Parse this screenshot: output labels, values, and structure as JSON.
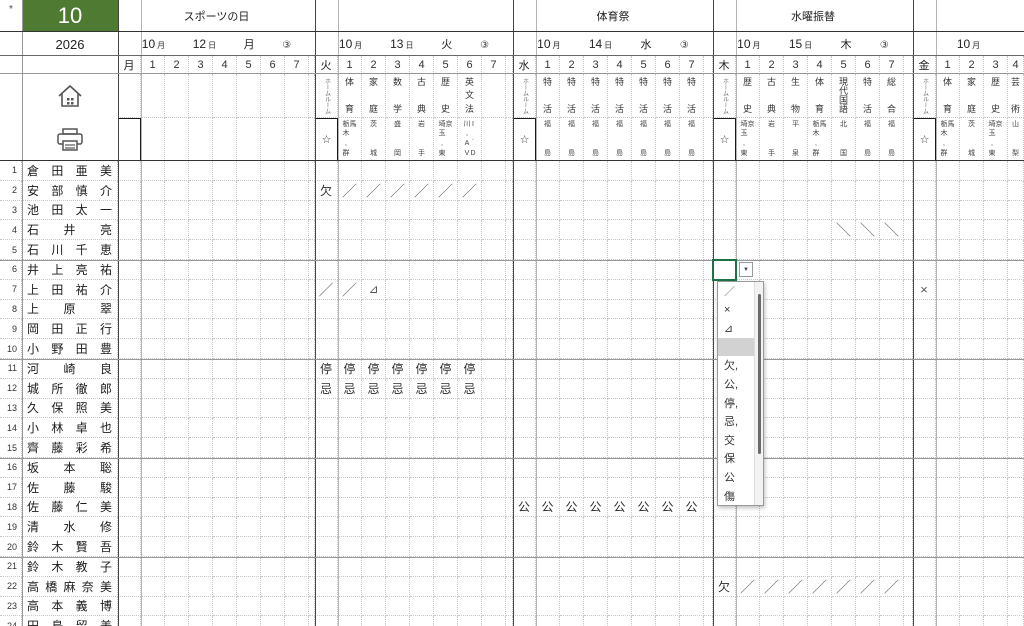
{
  "corner": "*",
  "title": {
    "month": "10",
    "year": "2026"
  },
  "banners": [
    "スポーツの日",
    "",
    "体育祭",
    "水曜振替",
    ""
  ],
  "periods": [
    "1",
    "2",
    "3",
    "4",
    "5",
    "6",
    "7"
  ],
  "blocks": [
    {
      "day": "月",
      "date_parts": [
        {
          "n": "10",
          "u": "月"
        },
        {
          "n": "12",
          "u": "日"
        },
        {
          "n": "月"
        },
        {
          "n": "③"
        }
      ],
      "homeroom": "",
      "star": "",
      "subjects": [
        "",
        "",
        "",
        "",
        "",
        "",
        ""
      ],
      "teachers": [
        "",
        "",
        "",
        "",
        "",
        "",
        ""
      ]
    },
    {
      "day": "火",
      "date_parts": [
        {
          "n": "10",
          "u": "月"
        },
        {
          "n": "13",
          "u": "日"
        },
        {
          "n": "火"
        },
        {
          "n": "③"
        }
      ],
      "homeroom": "ホームルーム",
      "star": "☆",
      "subjects": [
        "体育",
        "家庭",
        "数学",
        "古典",
        "歴史",
        "英文法",
        ""
      ],
      "teachers": [
        "栃木,群馬",
        "茨城",
        "盛岡",
        "岩手",
        "埼玉,東京",
        "川,AVI.D",
        ""
      ]
    },
    {
      "day": "水",
      "date_parts": [
        {
          "n": "10",
          "u": "月"
        },
        {
          "n": "14",
          "u": "日"
        },
        {
          "n": "水"
        },
        {
          "n": "③"
        }
      ],
      "homeroom": "ホームルーム",
      "star": "☆",
      "subjects": [
        "特活",
        "特活",
        "特活",
        "特活",
        "特活",
        "特活",
        "特活"
      ],
      "teachers": [
        "福島",
        "福島",
        "福島",
        "福島",
        "福島",
        "福島",
        "福島"
      ]
    },
    {
      "day": "木",
      "date_parts": [
        {
          "n": "10",
          "u": "月"
        },
        {
          "n": "15",
          "u": "日"
        },
        {
          "n": "木"
        },
        {
          "n": "③"
        }
      ],
      "homeroom": "ホームルーム",
      "star": "☆",
      "subjects": [
        "歴史",
        "古典",
        "生物",
        "体育",
        "現代国語",
        "特活",
        "総合"
      ],
      "teachers": [
        "埼玉,東京",
        "岩手",
        "平泉",
        "栃木,群馬",
        "北国",
        "福島",
        "福島"
      ]
    },
    {
      "day": "金",
      "date_parts": [
        {
          "n": "10",
          "u": "月"
        }
      ],
      "homeroom": "ホームルーム",
      "star": "☆",
      "subjects": [
        "体育",
        "家庭",
        "歴史",
        "芸術",
        "",
        "",
        ""
      ],
      "teachers": [
        "栃木,群馬",
        "茨城",
        "埼玉,東京",
        "山梨",
        "",
        "",
        ""
      ]
    }
  ],
  "students": [
    "倉田亜美",
    "安部慎介",
    "池田太一",
    "石井亮",
    "石川千恵",
    "井上亮祐",
    "上田祐介",
    "上原翠",
    "岡田正行",
    "小野田豊",
    "河崎良",
    "城所徹郎",
    "久保照美",
    "小林卓也",
    "齊藤彩希",
    "坂本聡",
    "佐藤駿",
    "佐藤仁美",
    "清水修",
    "鈴木賢吾",
    "鈴木教子",
    "高橋麻奈美",
    "高本義博",
    "田島留美"
  ],
  "marks": [
    {
      "row": 2,
      "block": 1,
      "cols": [
        0
      ],
      "text": "欠"
    },
    {
      "row": 2,
      "block": 1,
      "cols": [
        1,
        2,
        3,
        4,
        5,
        6
      ],
      "text": "／"
    },
    {
      "row": 4,
      "block": 3,
      "cols": [
        5,
        6,
        7
      ],
      "text": "＼"
    },
    {
      "row": 7,
      "block": 1,
      "cols": [
        0,
        1
      ],
      "text": "／"
    },
    {
      "row": 7,
      "block": 1,
      "cols": [
        2
      ],
      "text": "⊿"
    },
    {
      "row": 7,
      "block": 4,
      "cols": [
        0
      ],
      "text": "×"
    },
    {
      "row": 11,
      "block": 1,
      "cols": [
        0,
        1,
        2,
        3,
        4,
        5,
        6
      ],
      "text": "停"
    },
    {
      "row": 12,
      "block": 1,
      "cols": [
        0,
        1,
        2,
        3,
        4,
        5,
        6
      ],
      "text": "忌"
    },
    {
      "row": 18,
      "block": 2,
      "cols": [
        0,
        1,
        2,
        3,
        4,
        5,
        6,
        7
      ],
      "text": "公"
    },
    {
      "row": 22,
      "block": 3,
      "cols": [
        0
      ],
      "text": "欠"
    },
    {
      "row": 22,
      "block": 3,
      "cols": [
        1,
        2,
        3,
        4,
        5,
        6,
        7
      ],
      "text": "／"
    }
  ],
  "dropdown": {
    "row": 6,
    "block": 3,
    "arrow": "▼",
    "items": [
      "／",
      "×",
      "⊿",
      "",
      "欠,",
      "公,",
      "停,",
      "忌,",
      "交",
      "保",
      "公",
      "傷"
    ],
    "highlight_index": 3
  }
}
